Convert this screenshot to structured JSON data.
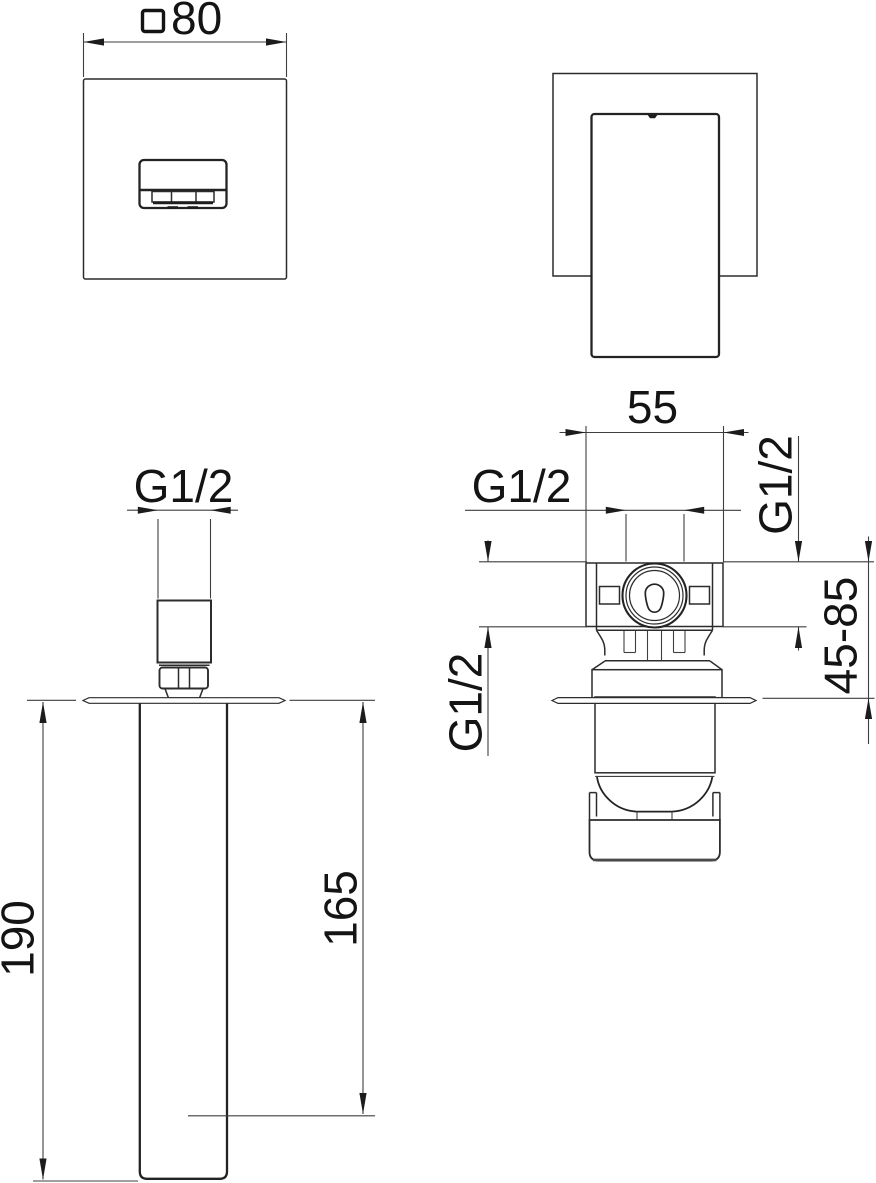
{
  "front_view": {
    "plate_size_symbol": "□",
    "plate_size_value": "80"
  },
  "spout_view": {
    "thread_label": "G1/2",
    "overall_length": "190",
    "outlet_distance": "165"
  },
  "valve_view": {
    "width": "55",
    "top_thread_label": "G1/2",
    "right_thread_label": "G1/2",
    "left_thread_label": "G1/2",
    "depth_range": "45-85"
  }
}
